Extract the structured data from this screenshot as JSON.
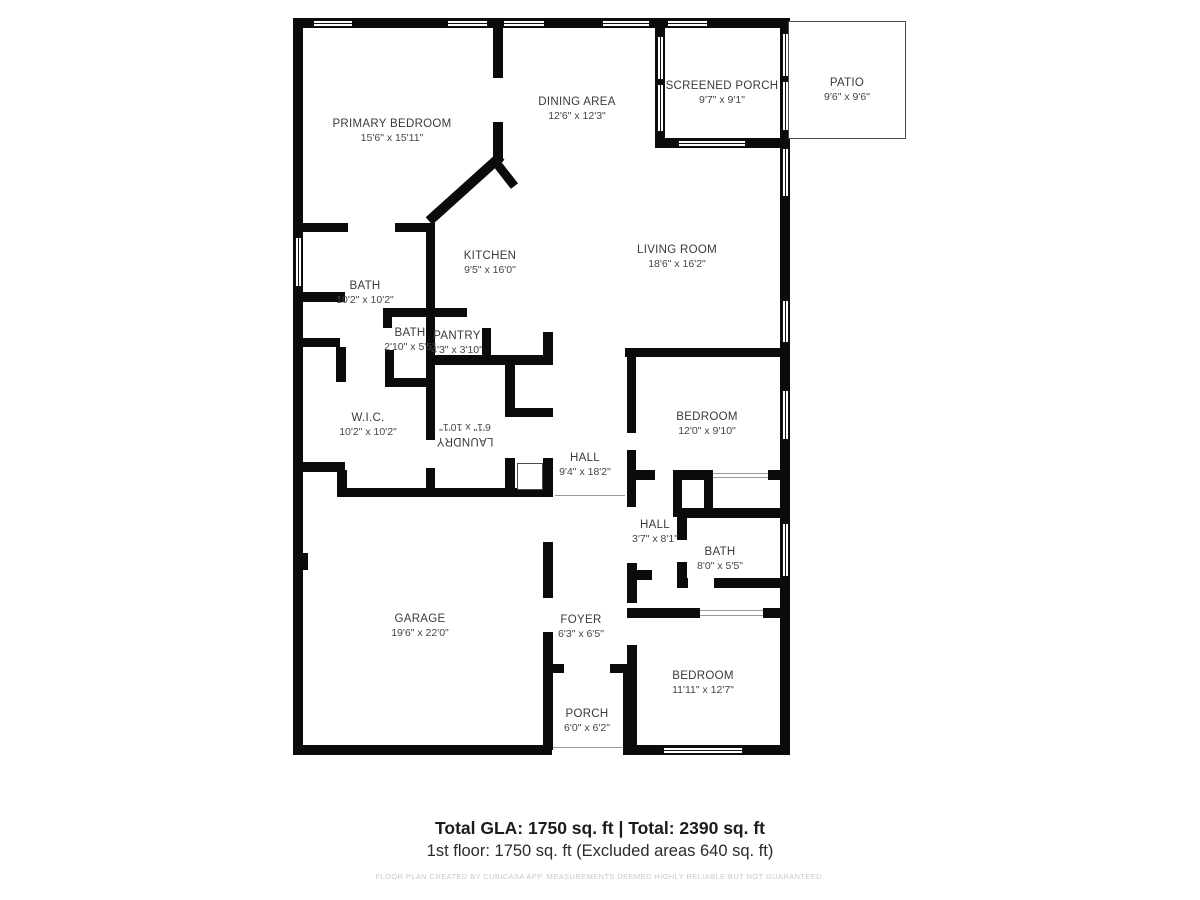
{
  "plan": {
    "rooms": [
      {
        "name": "PRIMARY BEDROOM",
        "dims": "15'6\" x 15'11\""
      },
      {
        "name": "DINING AREA",
        "dims": "12'6\" x 12'3\""
      },
      {
        "name": "SCREENED PORCH",
        "dims": "9'7\" x 9'1\""
      },
      {
        "name": "PATIO",
        "dims": "9'6\" x 9'6\""
      },
      {
        "name": "KITCHEN",
        "dims": "9'5\" x 16'0\""
      },
      {
        "name": "LIVING ROOM",
        "dims": "18'6\" x 16'2\""
      },
      {
        "name": "BATH",
        "dims": "10'2\" x 10'2\""
      },
      {
        "name": "BATH",
        "dims": "2'10\" x 5'5\""
      },
      {
        "name": "PANTRY",
        "dims": "4'3\" x 3'10\""
      },
      {
        "name": "W.I.C.",
        "dims": "10'2\" x 10'2\""
      },
      {
        "name": "LAUNDRY",
        "dims": "6'1\" x 10'1\""
      },
      {
        "name": "HALL",
        "dims": "9'4\" x 18'2\""
      },
      {
        "name": "BEDROOM",
        "dims": "12'0\" x 9'10\""
      },
      {
        "name": "HALL",
        "dims": "3'7\" x 8'1\""
      },
      {
        "name": "BATH",
        "dims": "8'0\" x 5'5\""
      },
      {
        "name": "GARAGE",
        "dims": "19'6\" x 22'0\""
      },
      {
        "name": "FOYER",
        "dims": "6'3\" x 6'5\""
      },
      {
        "name": "PORCH",
        "dims": "6'0\" x 6'2\""
      },
      {
        "name": "BEDROOM",
        "dims": "11'11\" x 12'7\""
      }
    ]
  },
  "summary": {
    "title": "Total GLA: 1750 sq. ft | Total: 2390 sq. ft",
    "line2": "1st floor: 1750 sq. ft (Excluded areas 640 sq. ft)",
    "disclaimer": "FLOOR PLAN CREATED BY CUBICASA APP. MEASUREMENTS DEEMED HIGHLY RELIABLE BUT NOT GUARANTEED."
  },
  "colors": {
    "wall": "#0b0b0b",
    "label_text": "#3a3a3a",
    "disclaimer_text": "#c9c9c9"
  }
}
